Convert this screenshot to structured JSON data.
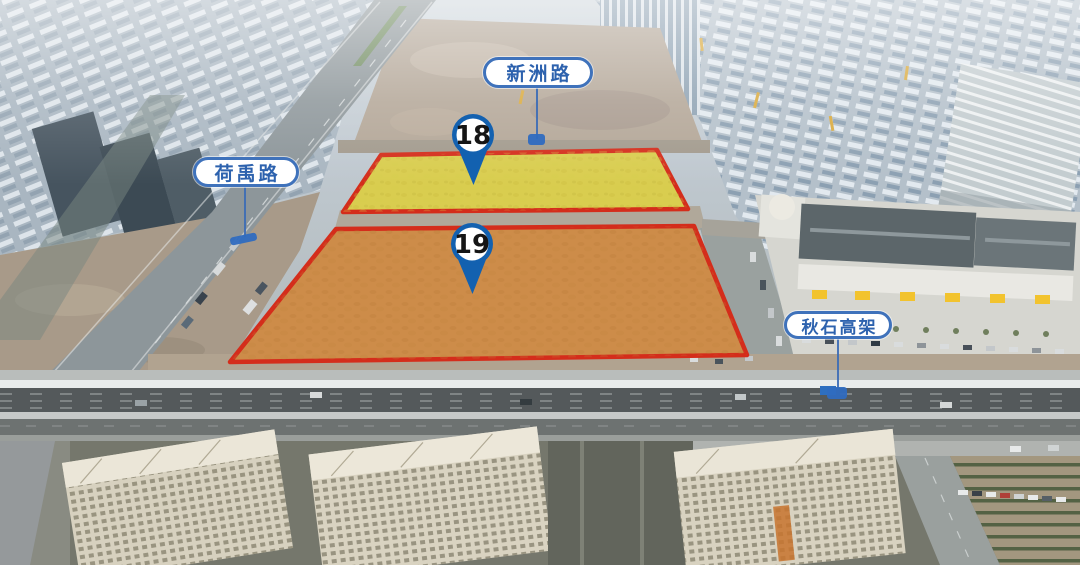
{
  "annotations": {
    "road_labels": [
      {
        "id": "xinzhou-road",
        "text": "新洲路"
      },
      {
        "id": "heyu-road",
        "text": "荷禹路"
      },
      {
        "id": "qiushi-elevated-road",
        "text": "秋石高架"
      }
    ],
    "parcels": [
      {
        "number": "18",
        "fill_color": "#d9cd4f",
        "border_color": "#d42d1b",
        "pin_color": "#1361b0"
      },
      {
        "number": "19",
        "fill_color": "#cd8c49",
        "border_color": "#d42d1b",
        "pin_color": "#1361b0"
      }
    ],
    "label_style": {
      "text_color": "#2d62ae",
      "border_color": "#3f72bb",
      "background_color": "#ffffff",
      "pointer_color": "#2f6cc0"
    }
  }
}
